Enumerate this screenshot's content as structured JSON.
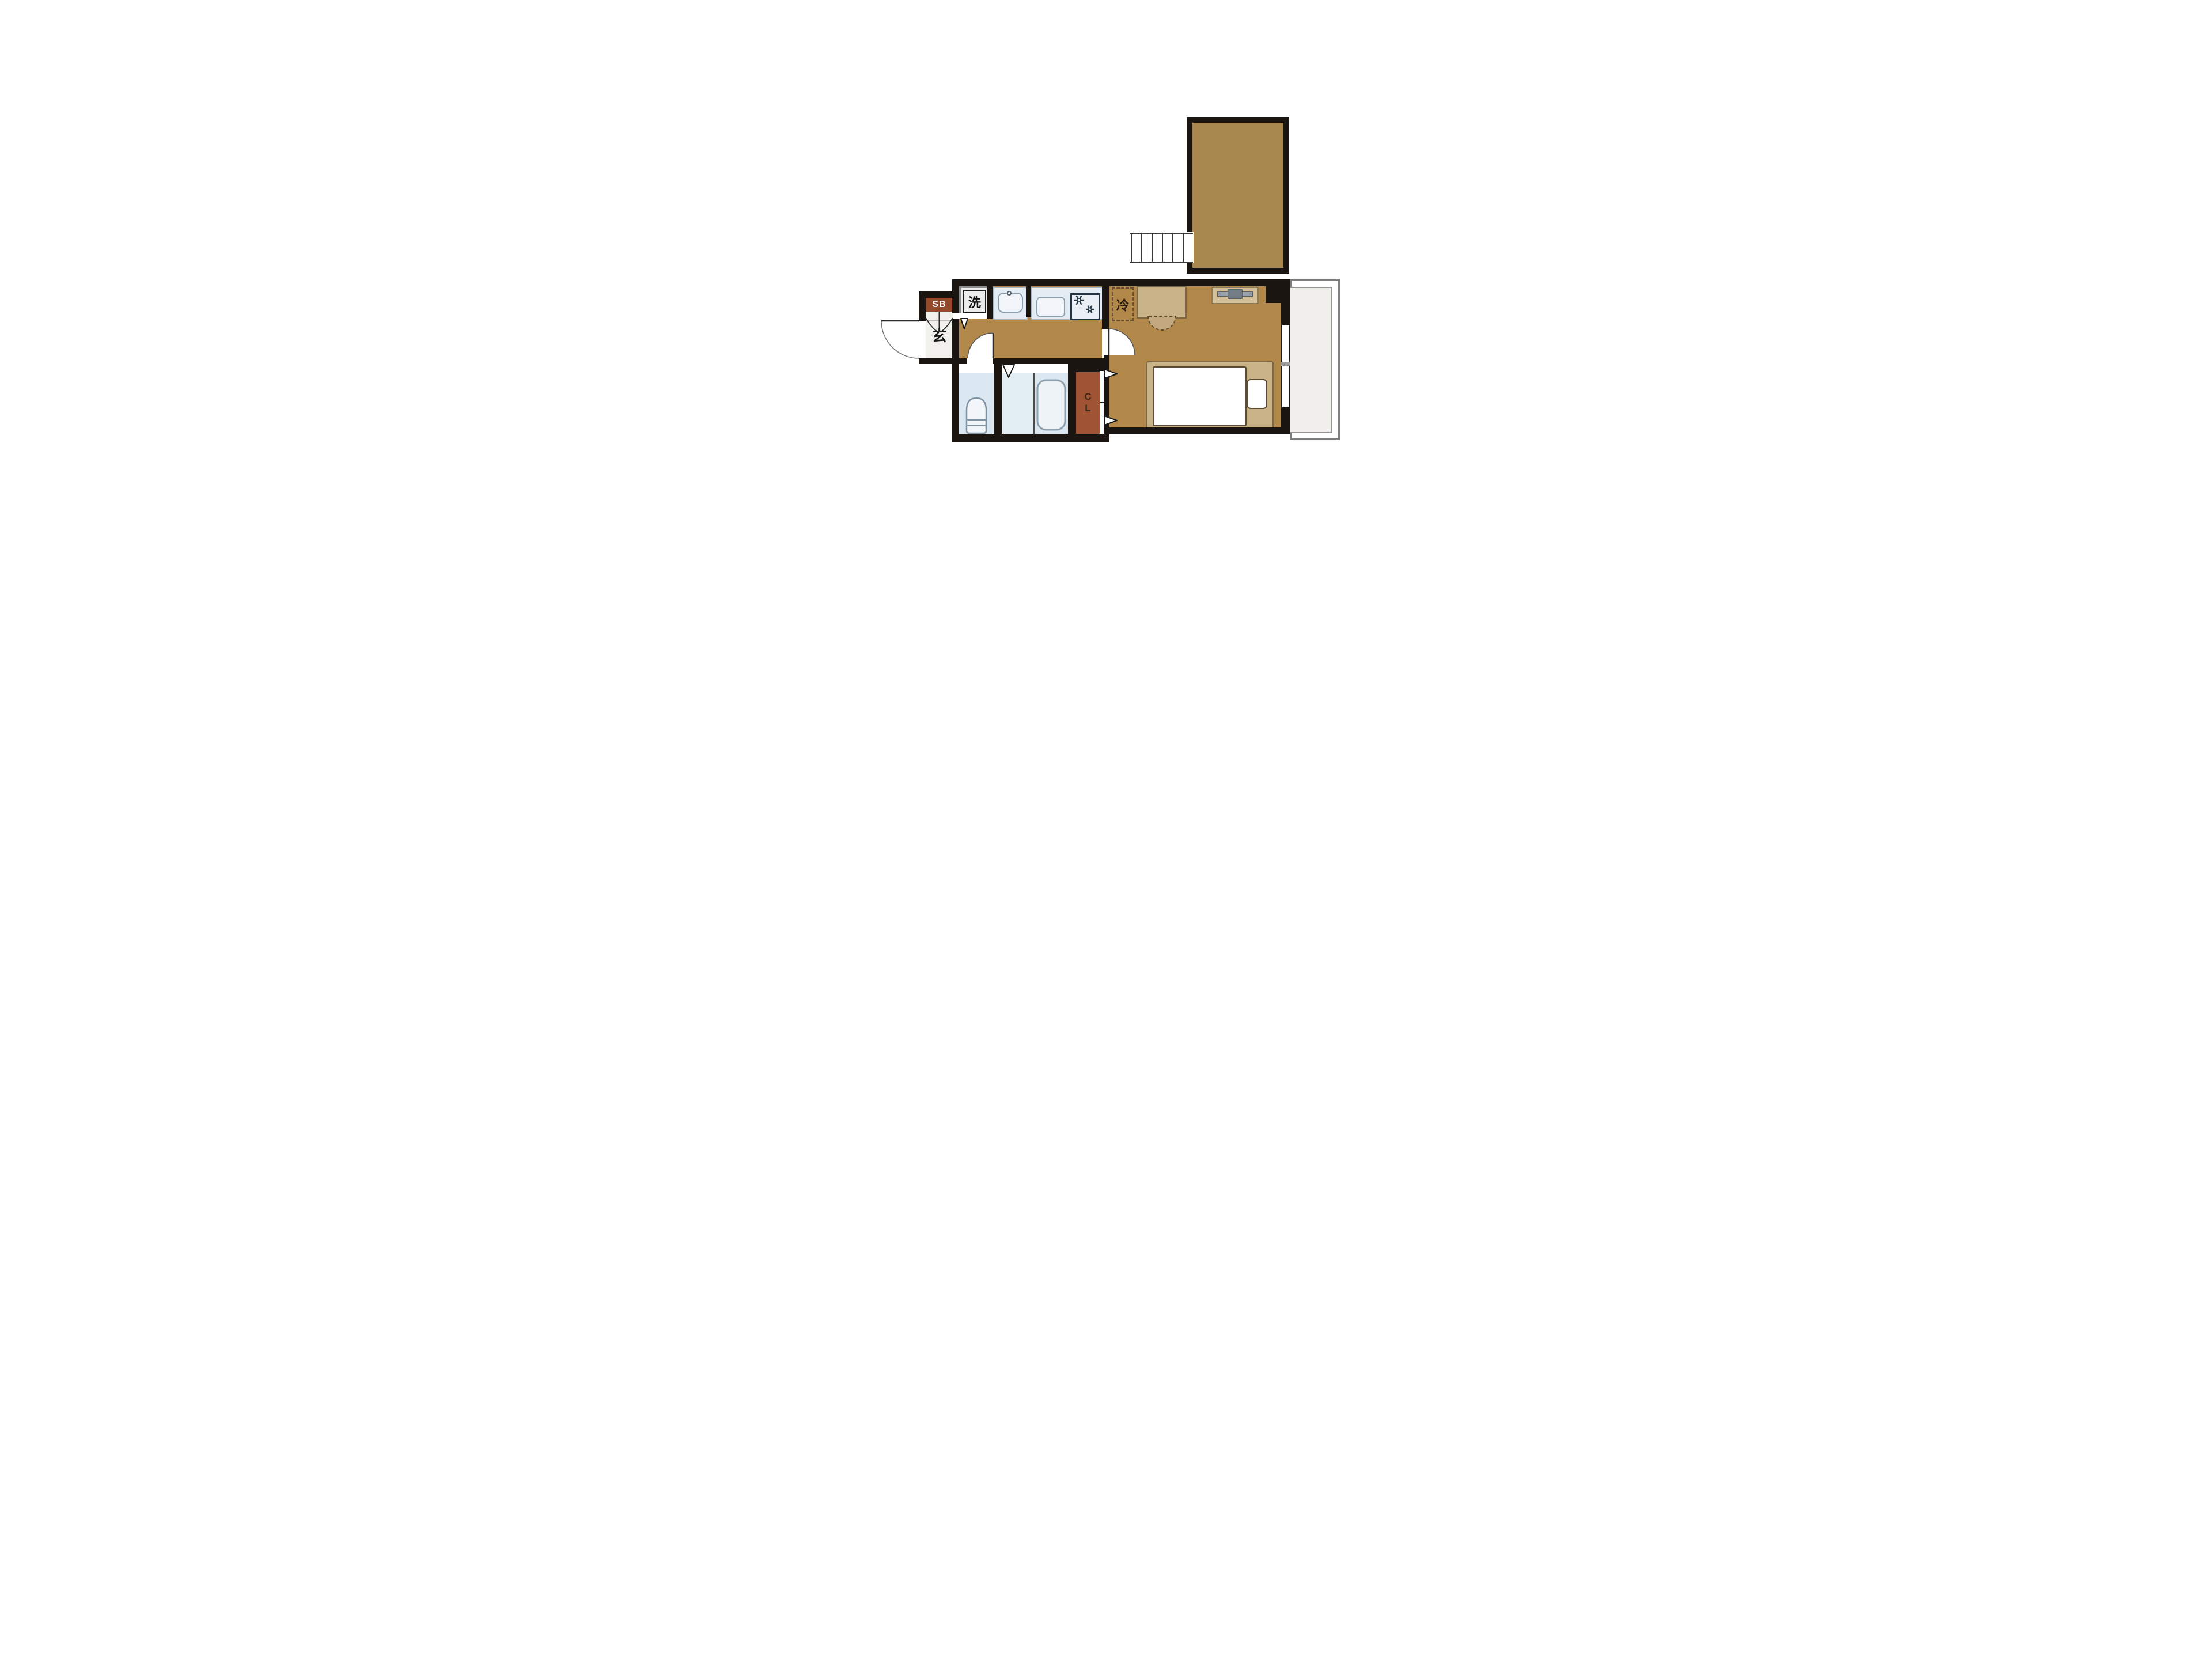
{
  "plan": {
    "type": "japanese-apartment-floor-plan",
    "labels": {
      "shoe_box": "SB",
      "entrance": "玄",
      "washing_machine": "洗",
      "refrigerator": "冷",
      "closet_c": "C",
      "closet_l": "L"
    },
    "colors": {
      "wall": "#1b1511",
      "floor": "#b1874a",
      "loft": "#a9884e",
      "genkan": "#f1f0ec",
      "shoebox": "#93492a",
      "closet": "#a05433",
      "wet": "#dce8f1",
      "counter": "#e3ebf3",
      "counterline": "#a8b6c4",
      "fixture": "#f2f6fa",
      "fixline": "#8da0af",
      "furn": "#c9b288",
      "furnline": "#7a6848",
      "balcony": "#f0efec",
      "tv": "#98a0a8",
      "tvdark": "#747c85",
      "board": "#d2bf97"
    }
  }
}
